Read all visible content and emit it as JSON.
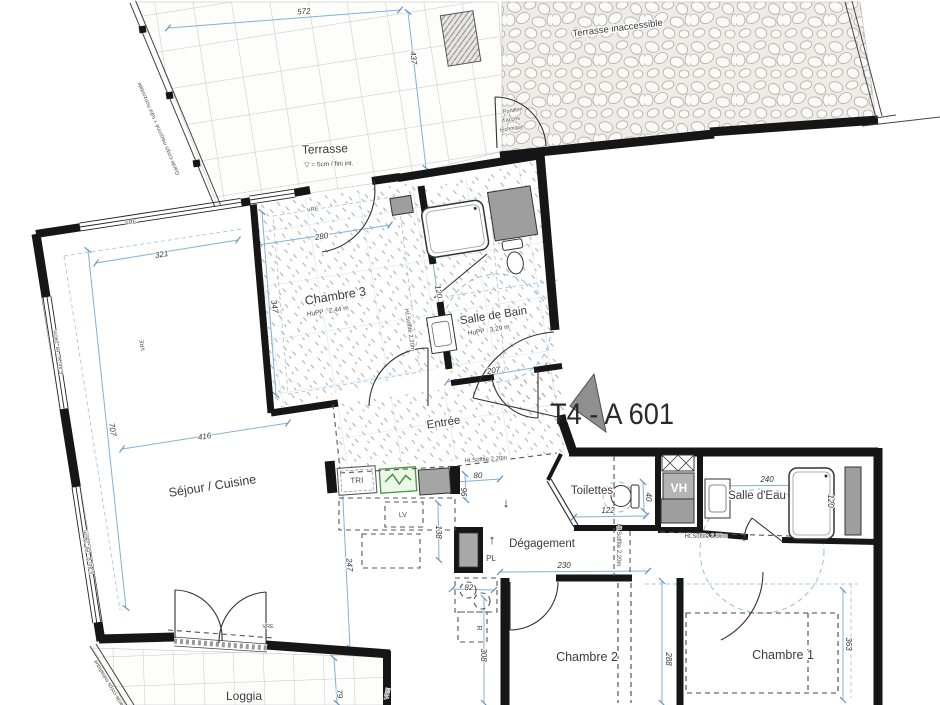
{
  "plan": {
    "title": "T4 - A 601",
    "colors": {
      "wall": "#161616",
      "dimension_line": "#7fb2d9",
      "panel_green": "#4a9a4a",
      "duct_gray": "#9e9e9e"
    },
    "rooms": [
      {
        "id": "terrasse",
        "name": "Terrasse",
        "x": 325,
        "y": 153,
        "rot": -2,
        "size": 12,
        "note": "▽ = 5cm / fini int.",
        "nx": 329,
        "ny": 166,
        "nsize": 6.5
      },
      {
        "id": "terrasse-inaccessible",
        "name": "Terrasse inaccessible",
        "x": 618,
        "y": 31,
        "rot": -7,
        "size": 9.5
      },
      {
        "id": "chambre-3",
        "name": "Chambre 3",
        "x": 336,
        "y": 300,
        "rot": -9,
        "size": 12.5,
        "note": "HuPP : 2,44 m",
        "nx": 328,
        "ny": 313,
        "nsize": 6.5
      },
      {
        "id": "salle-de-bain",
        "name": "Salle de Bain",
        "x": 494,
        "y": 319,
        "rot": -9,
        "size": 11.5,
        "note": "HuPP : 3,29 m",
        "nx": 489,
        "ny": 332,
        "nsize": 6.5
      },
      {
        "id": "entree",
        "name": "Entrée",
        "x": 444,
        "y": 426,
        "rot": -9,
        "size": 11.5
      },
      {
        "id": "sejour-cuisine",
        "name": "Séjour / Cuisine",
        "x": 213,
        "y": 490,
        "rot": -9,
        "size": 12.5
      },
      {
        "id": "toilettes",
        "name": "Toilettes",
        "x": 592,
        "y": 494,
        "rot": 0,
        "size": 11.5
      },
      {
        "id": "salle-d-eau",
        "name": "Salle d'Eau",
        "x": 757,
        "y": 499,
        "rot": 0,
        "size": 11.5
      },
      {
        "id": "degagement",
        "name": "Dégagement",
        "x": 542,
        "y": 547,
        "rot": 0,
        "size": 11.5
      },
      {
        "id": "chambre-2",
        "name": "Chambre 2",
        "x": 587,
        "y": 661,
        "rot": 0,
        "size": 12.5
      },
      {
        "id": "chambre-1",
        "name": "Chambre 1",
        "x": 783,
        "y": 659,
        "rot": 0,
        "size": 12.5
      },
      {
        "id": "loggia",
        "name": "Loggia",
        "x": 244,
        "y": 700,
        "rot": 0,
        "size": 12
      }
    ],
    "dimensions": [
      {
        "text": "572",
        "x": 304,
        "y": 14,
        "rot": -4
      },
      {
        "text": "437",
        "x": 411,
        "y": 58,
        "rot": 84
      },
      {
        "text": "321",
        "x": 162,
        "y": 257,
        "rot": -9
      },
      {
        "text": "280",
        "x": 322,
        "y": 239,
        "rot": -9
      },
      {
        "text": "347",
        "x": 272,
        "y": 307,
        "rot": 81
      },
      {
        "text": "707",
        "x": 110,
        "y": 430,
        "rot": 81
      },
      {
        "text": "416",
        "x": 205,
        "y": 439,
        "rot": -9
      },
      {
        "text": "247",
        "x": 347,
        "y": 565,
        "rot": 85
      },
      {
        "text": "120",
        "x": 436,
        "y": 292,
        "rot": 81
      },
      {
        "text": "207",
        "x": 494,
        "y": 373,
        "rot": -9
      },
      {
        "text": "80",
        "x": 478,
        "y": 478,
        "rot": -2
      },
      {
        "text": "96",
        "x": 461,
        "y": 492,
        "rot": 90
      },
      {
        "text": "138",
        "x": 436,
        "y": 532,
        "rot": 90
      },
      {
        "text": "82",
        "x": 469,
        "y": 590,
        "rot": -2
      },
      {
        "text": "308",
        "x": 481,
        "y": 655,
        "rot": 90
      },
      {
        "text": "122",
        "x": 608,
        "y": 513,
        "rot": 0
      },
      {
        "text": "40",
        "x": 646,
        "y": 497,
        "rot": 90
      },
      {
        "text": "230",
        "x": 564,
        "y": 568,
        "rot": 0
      },
      {
        "text": "240",
        "x": 767,
        "y": 482,
        "rot": 0
      },
      {
        "text": "120",
        "x": 828,
        "y": 501,
        "rot": 90
      },
      {
        "text": "288",
        "x": 666,
        "y": 659,
        "rot": 90
      },
      {
        "text": "363",
        "x": 846,
        "y": 644,
        "rot": 90
      },
      {
        "text": "79",
        "x": 337,
        "y": 694,
        "rot": 85
      }
    ],
    "annotations": [
      {
        "text": "Ht.Soffite 2,20m",
        "x": 486,
        "y": 461,
        "rot": -4,
        "size": 6,
        "dn": "soffit-note"
      },
      {
        "text": "Ht.Soffite 2,20m",
        "x": 408,
        "y": 330,
        "rot": 81,
        "size": 6,
        "dn": "soffit-note"
      },
      {
        "text": "Ht.Soffite 2,20m",
        "x": 617,
        "y": 545,
        "rot": 90,
        "size": 6,
        "dn": "soffit-note"
      },
      {
        "text": "Ht.Soffite 2,30m",
        "x": 706,
        "y": 538,
        "rot": 0,
        "size": 6,
        "dn": "soffit-note"
      },
      {
        "text": "Garde-corps maçonné + tube horizontale",
        "x": 160,
        "y": 128,
        "rot": -113,
        "size": 5.5,
        "dn": "guardrail-note"
      },
      {
        "text": "Garde-corps métallique",
        "x": 111,
        "y": 684,
        "rot": -121,
        "size": 5.5,
        "dn": "guardrail-note"
      },
      {
        "text": "Portillon",
        "x": 513,
        "y": 112,
        "rot": -9,
        "size": 5.5,
        "dn": "gate-note"
      },
      {
        "text": "d'accès",
        "x": 511,
        "y": 121,
        "rot": -9,
        "size": 5.5,
        "dn": "gate-note"
      },
      {
        "text": "technique",
        "x": 512,
        "y": 130,
        "rot": -9,
        "size": 5.5,
        "dn": "gate-note"
      },
      {
        "text": "F.Alu V - Ht. 24cm",
        "x": 60,
        "y": 352,
        "rot": -99,
        "size": 5.5,
        "dn": "window-note"
      },
      {
        "text": "F.Alu V - Ht. 24cm",
        "x": 90,
        "y": 552,
        "rot": -99,
        "size": 5.5,
        "dn": "window-note"
      },
      {
        "text": "VRE",
        "x": 131,
        "y": 224,
        "rot": -9,
        "size": 5.5,
        "dn": "shutter-label"
      },
      {
        "text": "VRE",
        "x": 313,
        "y": 211,
        "rot": -9,
        "size": 5.5,
        "dn": "shutter-label"
      },
      {
        "text": "VRE",
        "x": 144,
        "y": 345,
        "rot": -99,
        "size": 5.5,
        "dn": "shutter-label"
      },
      {
        "text": "VRE",
        "x": 268,
        "y": 628,
        "rot": 0,
        "size": 5.5,
        "dn": "shutter-label"
      },
      {
        "text": "VRE",
        "x": 389,
        "y": 694,
        "rot": -80,
        "size": 5.5,
        "dn": "shutter-label"
      },
      {
        "text": "TRI",
        "x": 357,
        "y": 483,
        "rot": -3,
        "size": 8,
        "dn": "tri-label"
      },
      {
        "text": "LV",
        "x": 403,
        "y": 517,
        "rot": -3,
        "size": 7,
        "dn": "dishwasher-label"
      },
      {
        "text": "PL",
        "x": 491,
        "y": 561,
        "rot": 0,
        "size": 8,
        "dn": "closet-label"
      },
      {
        "text": "R",
        "x": 477,
        "y": 628,
        "rot": 90,
        "size": 7,
        "dn": "fridge-label"
      },
      {
        "text": "VH",
        "x": 679,
        "y": 492,
        "rot": 0,
        "size": 12,
        "cls": "vh",
        "dn": "vh-label"
      },
      {
        "text": "↓",
        "x": 506,
        "y": 507,
        "rot": 0,
        "size": 13,
        "cls": "arrow",
        "dn": "down-arrow"
      },
      {
        "text": "↑",
        "x": 492,
        "y": 544,
        "rot": 0,
        "size": 13,
        "cls": "arrow",
        "dn": "up-arrow"
      }
    ]
  }
}
